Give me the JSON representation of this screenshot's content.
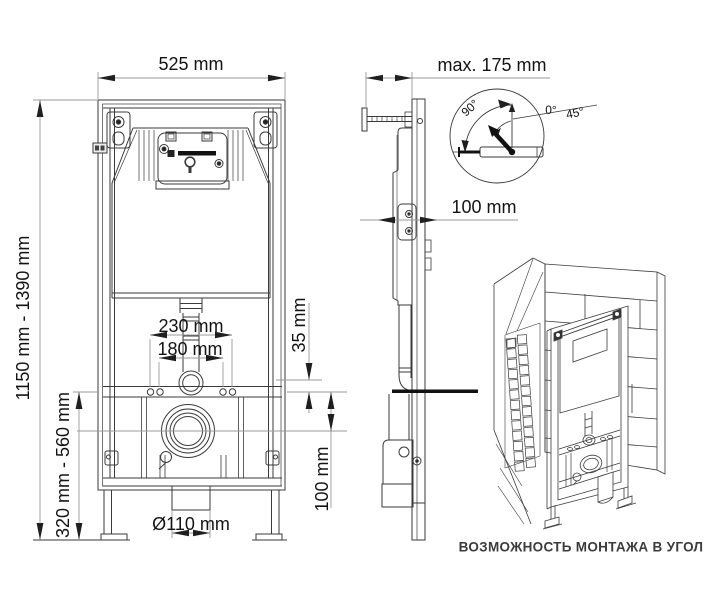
{
  "drawing": {
    "dims": {
      "width": "525 mm",
      "max_depth": "max. 175 mm",
      "depth": "100 mm",
      "spacing_outer": "230 mm",
      "spacing_inner": "180 mm",
      "offset": "35 mm",
      "outlet_height": "100 mm",
      "drain_diameter": "Ø110 mm",
      "height_range": "1150 mm - 1390 mm",
      "outlet_range": "320 mm - 560 mm"
    },
    "angles": {
      "full": "90°",
      "zero": "0°",
      "half": "45°"
    },
    "caption": "ВОЗМОЖНОСТЬ МОНТАЖА В УГОЛ",
    "colors": {
      "line": "#3a3a3a",
      "dim": "#9a9a9a",
      "text": "#131313",
      "caption": "#3c3c3c",
      "bg": "#ffffff"
    }
  }
}
